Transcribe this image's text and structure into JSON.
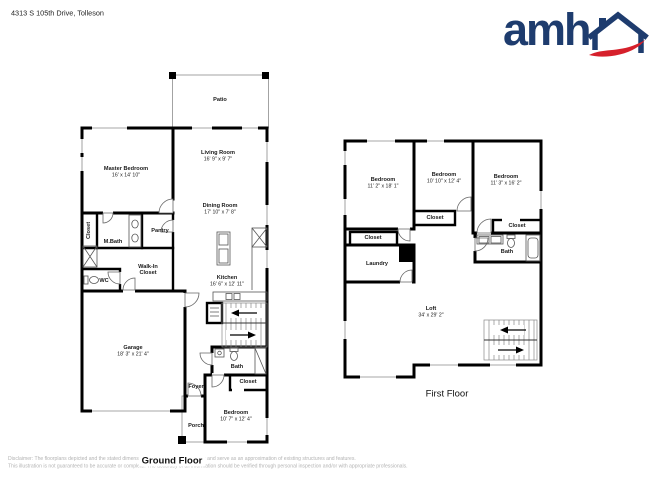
{
  "header": {
    "address": "4313 S 105th Drive, Tolleson"
  },
  "logo": {
    "wordmark": "amh",
    "brand_blue": "#1e3c6e",
    "brand_red": "#d6202b"
  },
  "ground_floor": {
    "caption": "Ground Floor",
    "rooms": {
      "patio": {
        "name": "Patio"
      },
      "master_bedroom": {
        "name": "Master Bedroom",
        "dims": "16' x 14' 10\""
      },
      "living_room": {
        "name": "Living Room",
        "dims": "16' 9\" x 9' 7\""
      },
      "dining_room": {
        "name": "Dining Room",
        "dims": "17' 10\" x 7' 8\""
      },
      "closet": {
        "name": "Closet"
      },
      "m_bath": {
        "name": "M.Bath"
      },
      "pantry": {
        "name": "Pantry"
      },
      "walk_in_closet": {
        "name_line1": "Walk-In",
        "name_line2": "Closet"
      },
      "wc": {
        "name": "WC"
      },
      "kitchen": {
        "name": "Kitchen",
        "dims": "16' 6\" x 12' 11\""
      },
      "garage": {
        "name": "Garage",
        "dims": "18' 3\" x 21' 4\""
      },
      "bath": {
        "name": "Bath"
      },
      "bedroom_closet": {
        "name": "Closet"
      },
      "bedroom": {
        "name": "Bedroom",
        "dims": "10' 7\" x 12' 4\""
      },
      "foyer": {
        "name": "Foyer"
      },
      "porch": {
        "name": "Porch"
      }
    }
  },
  "first_floor": {
    "caption": "First Floor",
    "rooms": {
      "bedroom_left": {
        "name": "Bedroom",
        "dims": "11' 2\" x 18' 1\""
      },
      "bedroom_middle": {
        "name": "Bedroom",
        "dims": "10' 10\" x 12' 4\""
      },
      "bedroom_right": {
        "name": "Bedroom",
        "dims": "11' 3\" x 16' 2\""
      },
      "closet_middle": {
        "name": "Closet"
      },
      "closet_left": {
        "name": "Closet"
      },
      "closet_right": {
        "name": "Closet"
      },
      "laundry": {
        "name": "Laundry"
      },
      "bath": {
        "name": "Bath"
      },
      "loft": {
        "name": "Loft",
        "dims": "34' x 29' 2\""
      }
    }
  },
  "disclaimer": {
    "line1": "Disclaimer: The floorplans depicted and the stated dimensions herein are indicative only and serve as an approximation of existing structures and features.",
    "line2": "This illustration is not guaranteed to be accurate or complete. The accuracy of all information should be verified through personal inspection and/or with appropriate professionals."
  }
}
